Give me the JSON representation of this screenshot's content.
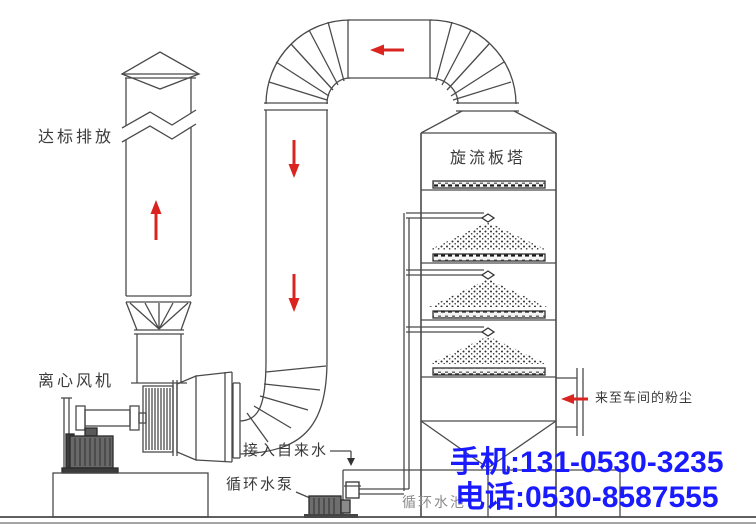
{
  "diagram": {
    "labels": {
      "emission": "达标排放",
      "fan": "离心风机",
      "tower": "旋流板塔",
      "tap_water": "接入自来水",
      "pump": "循环水泵",
      "pool": "循环水池",
      "dust_inlet": "来至车间的粉尘"
    },
    "contact": {
      "mobile": "手机:131-0530-3235",
      "phone": "电话:0530-8587555"
    },
    "colors": {
      "flow_arrow": "#d92420",
      "line": "#4a4a4a",
      "contact_text": "#1a1aff"
    }
  }
}
